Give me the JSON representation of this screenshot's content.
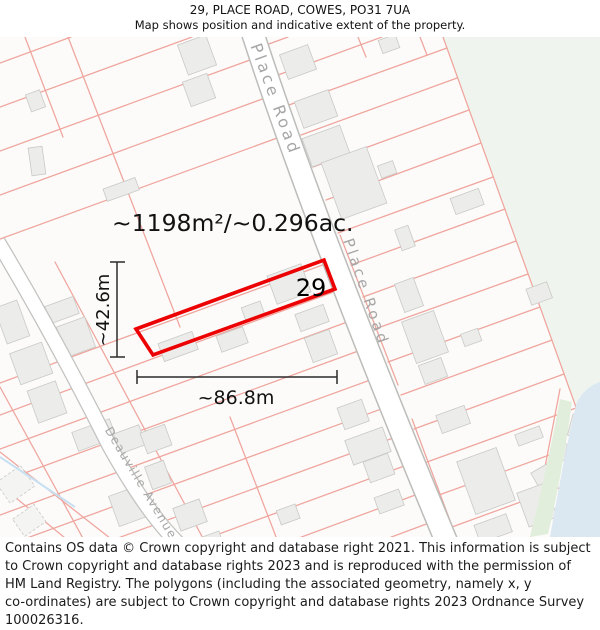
{
  "header": {
    "title": "29, PLACE ROAD, COWES, PO31 7UA",
    "subtitle": "Map shows position and indicative extent of the property."
  },
  "map": {
    "property_number": "29",
    "area_label": "~1198m²/~0.296ac.",
    "width_label": "~86.8m",
    "height_label": "~42.6m",
    "roads": {
      "place_road_upper": "Place Road",
      "place_road_lower": "Place Road",
      "deauville_avenue": "Deauville Avenue"
    },
    "colors": {
      "property_outline": "#ec0202",
      "parcel_line": "#efa49c",
      "building_fill": "#ececea",
      "building_stroke": "#c9c9c6",
      "field_green": "#eff5ee",
      "water_blue": "#dbe8f2",
      "road_label_gray": "#a6a6a6",
      "dimension_black": "#2b2b2b"
    }
  },
  "footer": {
    "lines": [
      "Contains OS data © Crown copyright and database right 2021. This information is subject",
      "to Crown copyright and database rights 2023 and is reproduced with the permission of",
      "HM Land Registry. The polygons (including the associated geometry, namely x, y",
      "co-ordinates) are subject to Crown copyright and database rights 2023 Ordnance Survey",
      "100026316."
    ]
  }
}
